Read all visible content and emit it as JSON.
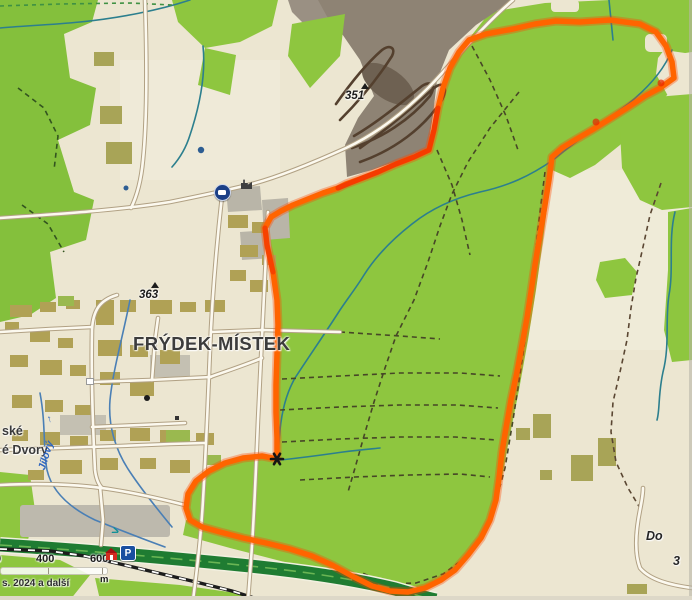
{
  "map": {
    "title_labels": {
      "city": "FRÝDEK-MÍSTEK",
      "district_partial_top": "ské",
      "district_partial_bottom": "é Dvory",
      "stream": "Jílový",
      "stream_arrow": "↑",
      "right_edge_partial_word": "Do",
      "right_edge_partial_number": "3"
    },
    "elevation_points": [
      {
        "value": "363"
      },
      {
        "value": "351"
      }
    ],
    "scale_bar": {
      "tick_partial": "0",
      "tick_mid": "400",
      "tick_end": "600",
      "unit": "m"
    },
    "attribution": "s. 2024 a další",
    "icons": {
      "parking_label": "P",
      "flow_arrow": ">"
    },
    "colors": {
      "route_outline": "#ff6400",
      "forest_green": "#8ec63f",
      "field_beige": "#ece6d1",
      "quarry_gray": "#8e8374",
      "highway_green": "#1f7c32",
      "water_teal": "#2c7f8e",
      "stream_label_blue": "#2f66c0"
    }
  }
}
